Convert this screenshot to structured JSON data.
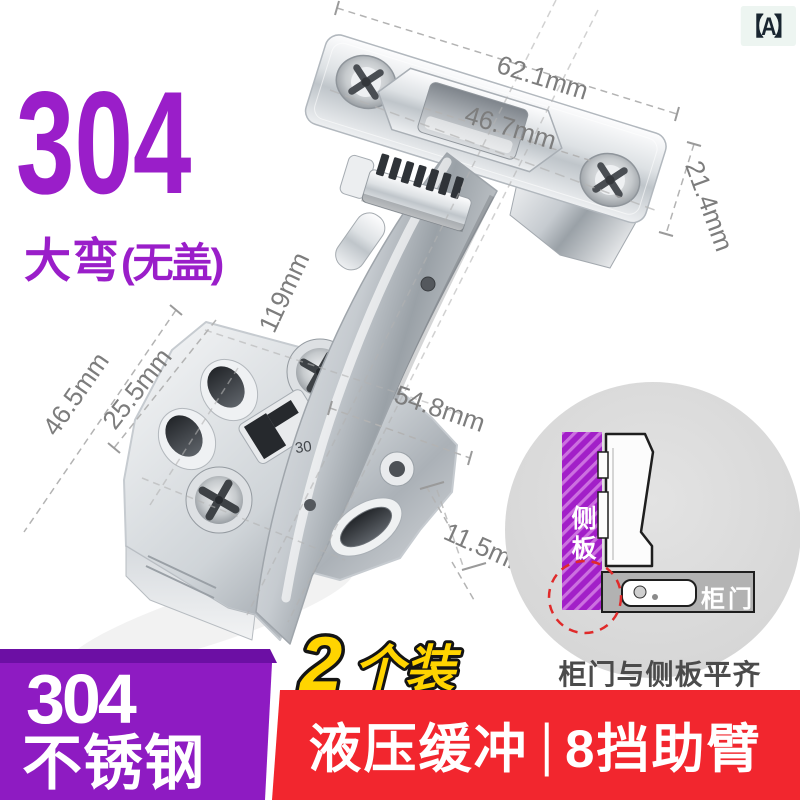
{
  "variant_badge": {
    "label": "【A】"
  },
  "header": {
    "model": "304",
    "type": "大弯",
    "type_note": "(无盖)"
  },
  "dimensions": {
    "plate_width": "62.1mm",
    "cup_width": "46.7mm",
    "plate_height": "21.4mm",
    "arm_length": "119mm",
    "base_width": "46.5mm",
    "hole_spacing": "25.5mm",
    "base_length": "54.8mm",
    "slot_mark": "30",
    "edge_step": "11.5mm"
  },
  "install_diagram": {
    "side_panel_label": "侧板",
    "door_label": "柜门",
    "caption": "柜门与侧板平齐"
  },
  "pack": {
    "number": "2",
    "unit": "个装"
  },
  "material": {
    "grade": "304",
    "name": "不锈钢"
  },
  "banner": {
    "left": "液压缓冲",
    "divider": "|",
    "right": "8挡助臂"
  },
  "colors": {
    "accent_purple": "#9a1ec9",
    "block_purple": "#8e1bc2",
    "strip_purple": "#6c0fa4",
    "banner_red": "#f2262e",
    "pack_yellow": "#ffd400",
    "badge_bg": "#edf5f1",
    "dimension_gray": "#7d7d7d",
    "diagram_circle_gray": "#dadada"
  }
}
